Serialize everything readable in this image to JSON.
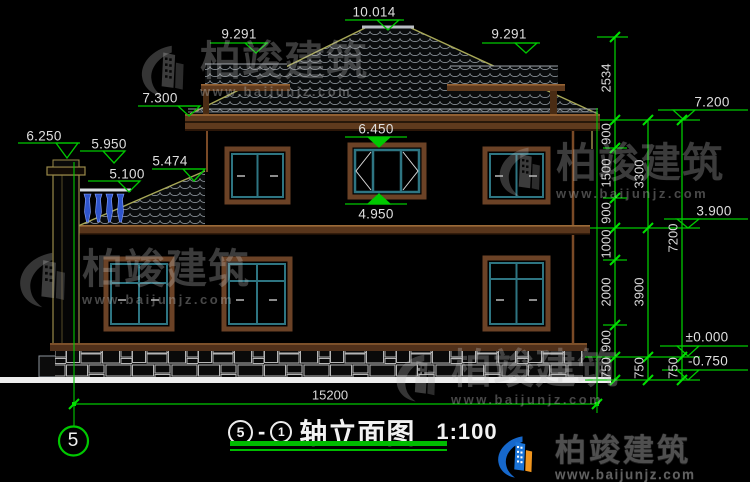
{
  "drawing": {
    "type": "house-elevation-cad",
    "background": "#000000",
    "accent_green": "#00c800",
    "frame_brown": "#6b4226",
    "sash_teal": "#2e7582",
    "roof_edge_olive": "#a8a857",
    "baluster_blue": "#2f55cc"
  },
  "levels": {
    "ridge": "10.014",
    "wing_left": "9.291",
    "wing_right": "9.291",
    "eave_left": "7.300",
    "chimney": "6.250",
    "railing": "5.950",
    "pent_roof": "5.474",
    "terrace": "5.100",
    "window_head": "6.450",
    "window_sill": "4.950",
    "eave_right": "7.200",
    "second_floor": "3.900",
    "zero": "±0.000",
    "ground": "-0.750"
  },
  "dims": {
    "inner": [
      "2534",
      "900",
      "1500",
      "900",
      "1000",
      "2000",
      "900",
      "750"
    ],
    "middle": [
      "3300",
      "3900",
      "750"
    ],
    "outer": [
      "7200",
      "750"
    ],
    "total_width": "15200"
  },
  "axis": {
    "number": "5"
  },
  "title": {
    "axis_start": "5",
    "axis_sep": "-",
    "axis_end": "1",
    "name": "轴立面图",
    "scale": "1:100"
  },
  "watermark": {
    "brand": "柏竣建筑",
    "url": "www.baijunjz.com"
  },
  "logo": {
    "brand": "柏竣建筑",
    "url": "www.baijunjz.com"
  }
}
